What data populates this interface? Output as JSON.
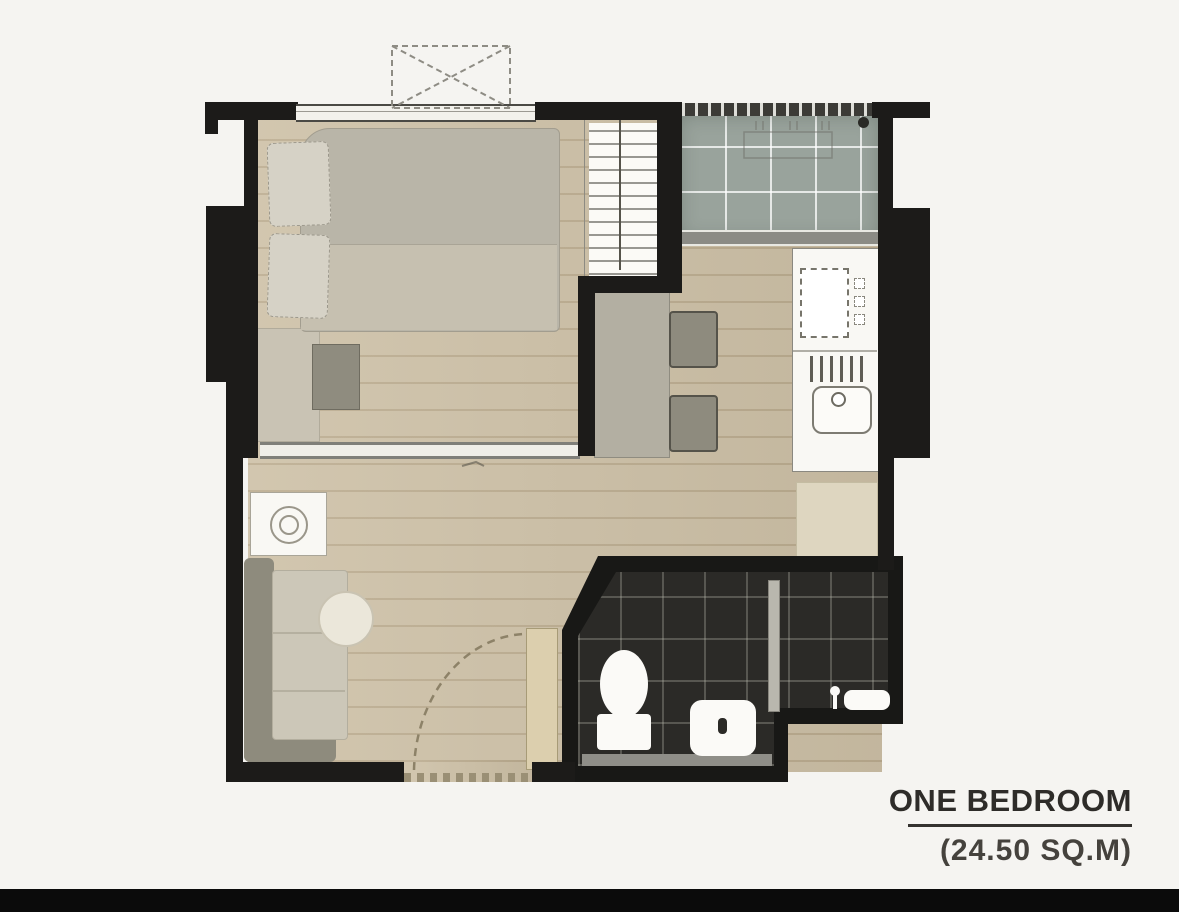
{
  "labels": {
    "title": "ONE BEDROOM",
    "area": "(24.50 SQ.M)"
  },
  "plan": {
    "rooms": [
      "bedroom",
      "balcony",
      "kitchen",
      "living-area",
      "bathroom",
      "entrance"
    ],
    "fixtures": [
      "bed",
      "pillows",
      "wardrobe",
      "dresser",
      "bench",
      "sliding-partition",
      "dining-counter",
      "stool",
      "stool",
      "kitchen-counter",
      "stove",
      "sink",
      "drainboard",
      "kitchen-mat",
      "washing-machine",
      "sofa",
      "round-table",
      "entry-door",
      "door-swing",
      "toilet",
      "vanity-sink",
      "shower-head",
      "shower-shelf",
      "glass-partition",
      "ac-condenser",
      "balcony-drain",
      "window"
    ],
    "colors": {
      "background": "#f5f4f1",
      "walls": "#1c1b19",
      "wood_floor": "#cdc0a6",
      "balcony_tile": "#99a39c",
      "bathroom_tile": "#2b2a27",
      "fixture_white": "#f9f8f4",
      "furniture_gray": "#8e8b7d",
      "text": "#2e2c29",
      "letterbox": "#0b0b0b"
    }
  }
}
